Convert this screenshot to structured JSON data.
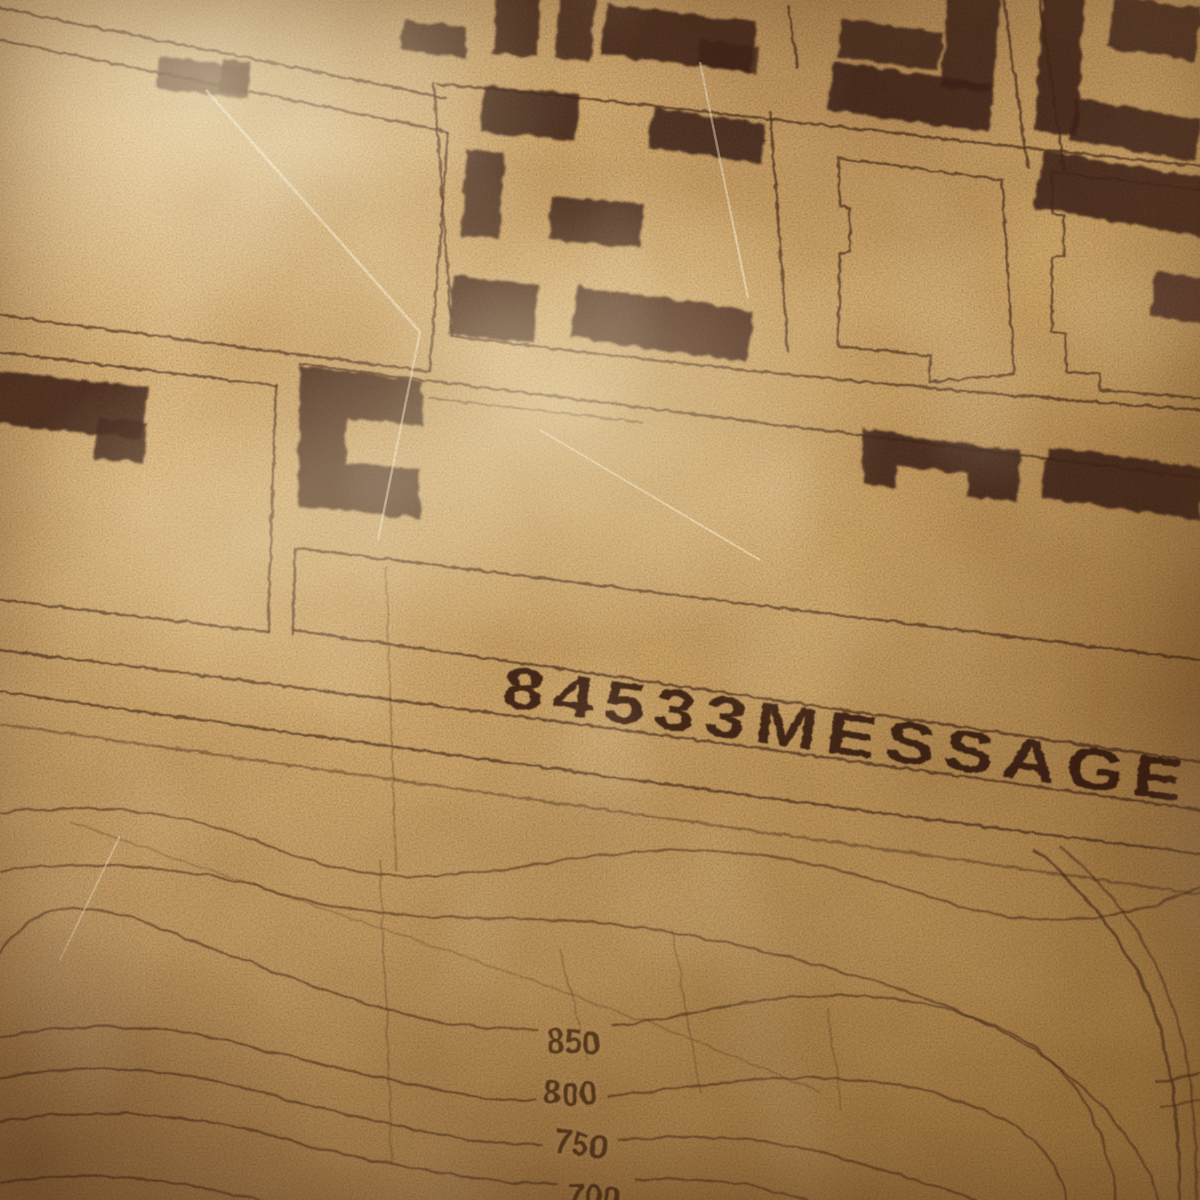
{
  "map": {
    "kind": "vintage-topographic-city-map",
    "stamp_text": "84533MESSAGE",
    "contour_labels": [
      "850",
      "800",
      "750",
      "700"
    ]
  },
  "palette": {
    "paper": "#d2ac72",
    "paper_light": "#ecd4a4",
    "paper_dark": "#a87f4d",
    "street_ink": "#523220",
    "building_ink": "#46281d",
    "contour_ink": "#5e3c26",
    "stamp_ink": "#33190e",
    "label_ink": "#4f3018",
    "label_halo": "#cfa76e"
  }
}
